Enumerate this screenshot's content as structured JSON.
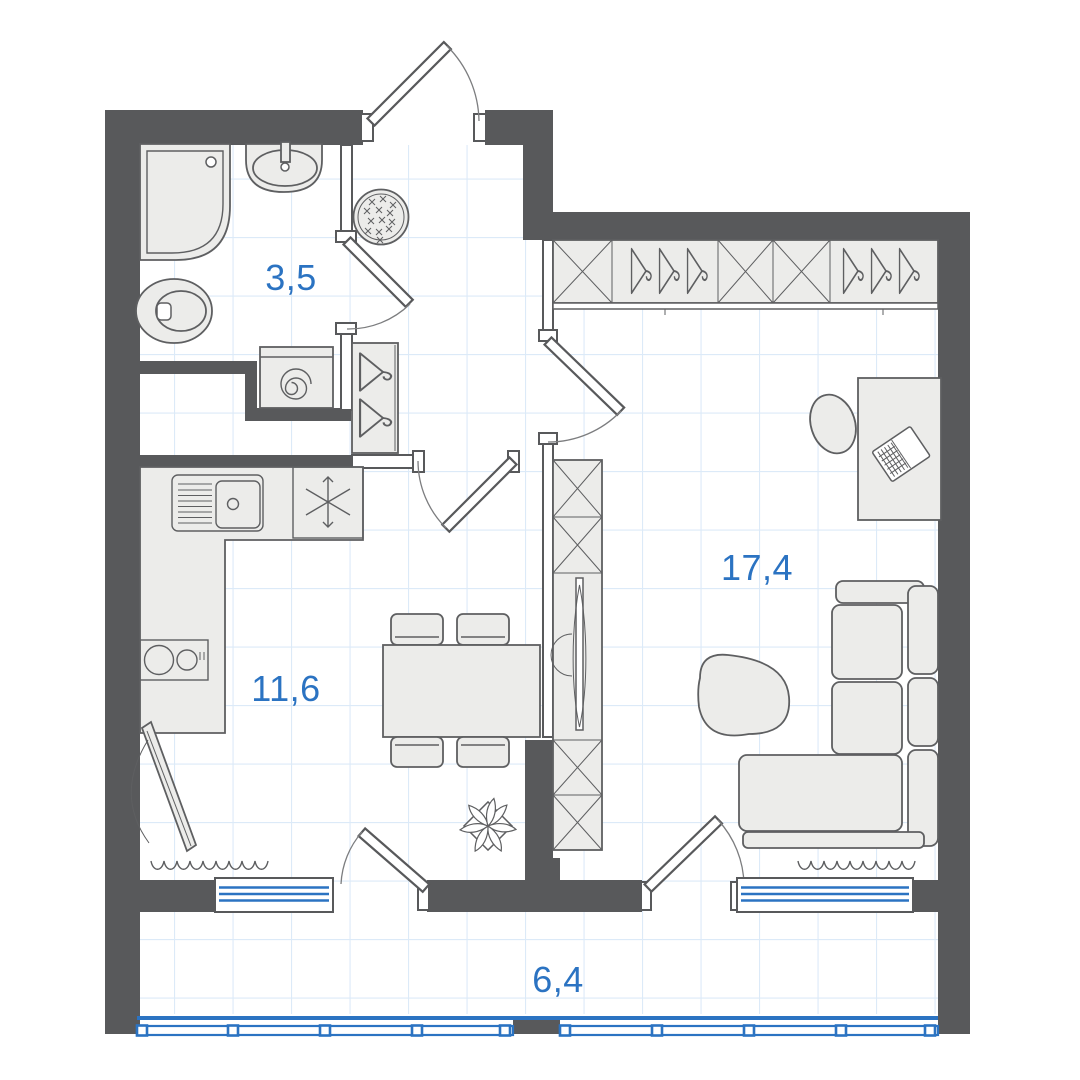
{
  "plan": {
    "rooms": [
      {
        "id": "bathroom",
        "area": "3,5"
      },
      {
        "id": "kitchen_dining",
        "area": "11,6"
      },
      {
        "id": "living_room",
        "area": "17,4"
      },
      {
        "id": "balcony",
        "area": "6,4"
      }
    ]
  },
  "colors": {
    "background": "#FFFFFF",
    "wall": "#58595B",
    "furniture_fill": "#ECECEA",
    "furniture_stroke": "#5E5F61",
    "accent_blue": "#2B73C2",
    "grid_line": "#DCEAF8",
    "arc": "#7C7D7F"
  },
  "fixtures": [
    "shower",
    "washbasin",
    "toilet",
    "washing-machine",
    "ottoman",
    "coat-hangers",
    "entrance-door",
    "wardrobe",
    "tv-stand",
    "desk",
    "desk-chair",
    "laptop",
    "sofa",
    "coffee-table",
    "kitchen-sink",
    "refrigerator",
    "cooktop",
    "dining-table",
    "chair",
    "plant",
    "ironing-board",
    "radiator",
    "window",
    "balcony-glazing"
  ]
}
